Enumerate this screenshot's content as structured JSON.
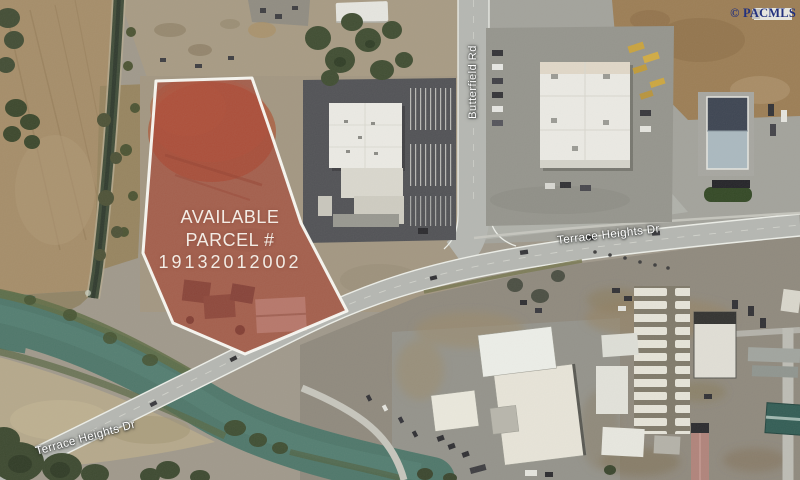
{
  "map": {
    "watermark": "© PACMLS",
    "parcel": {
      "line1": "AVAILABLE",
      "line2": "PARCEL #",
      "line3": "19132012002"
    },
    "road_labels": {
      "terrace_main": "Terrace Heights Dr",
      "terrace_bottom": "Terrace Heights Dr",
      "butterfield": "Butterfield Rd"
    }
  },
  "colors": {
    "parcel-red": "#a63a2c",
    "parcel-border": "#fcfcf7",
    "parcel-text": "#f3ece5",
    "road-label-text": "#ffffff",
    "watermark-navy": "#23317e",
    "river-teal": "#4b7568",
    "canal-green": "#3d4a36",
    "road-gray": "#b5b7b2",
    "road-edge": "#eef0ea",
    "dark-lot": "#4e4f53",
    "pale-roof": "#edece6",
    "field-tan": "#a58c67",
    "dirt-brown": "#9b7c52",
    "gravel-tan": "#b5a88a",
    "tree-green": "#3c4a2e"
  }
}
